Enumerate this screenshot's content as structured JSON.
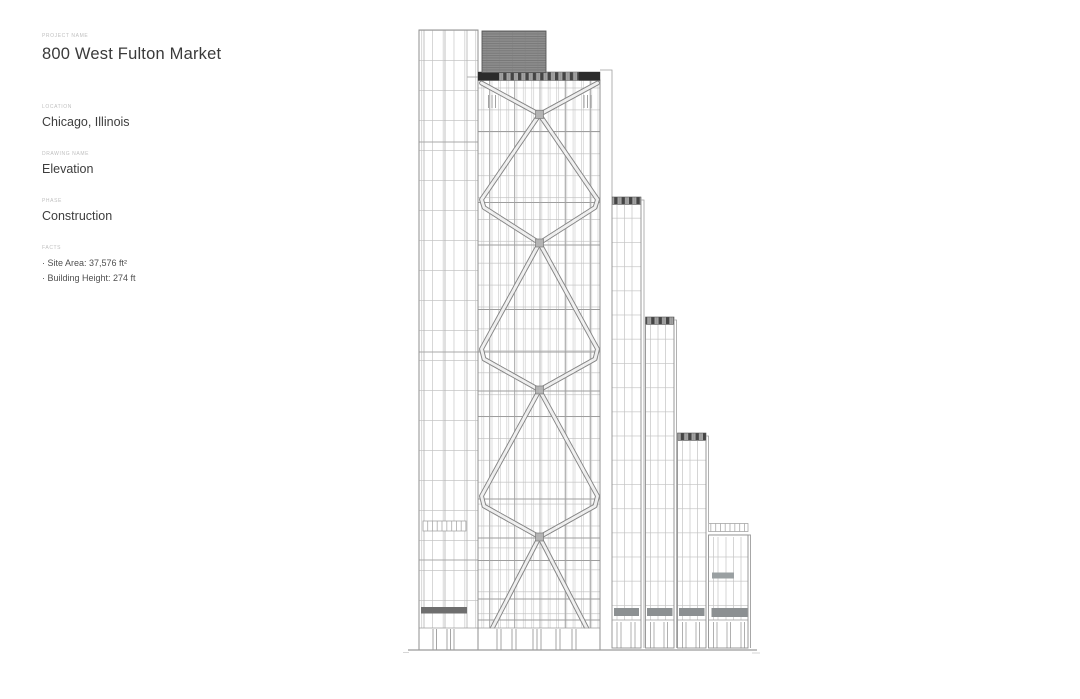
{
  "panel": {
    "fields": [
      {
        "label": "PROJECT NAME",
        "value": "800 West Fulton Market"
      },
      {
        "label": "LOCATION",
        "value": "Chicago, Illinois"
      },
      {
        "label": "DRAWING NAME",
        "value": "Elevation"
      },
      {
        "label": "PHASE",
        "value": "Construction"
      }
    ],
    "facts_label": "FACTS",
    "facts": [
      "· Site Area: 37,576 ft²",
      "· Building Height: 274 ft"
    ]
  },
  "drawing": {
    "title": "Building elevation line drawing",
    "building": "800 West Fulton Market tower with X-braced facade, rooftop mechanical penthouse and four stepped setback wings descending to the east",
    "colors": {
      "line_light": "#c6c6c6",
      "line_medium": "#8f8f8f",
      "penthouse_gray": "#8e8e8e",
      "parapet_dark": "#2c2c2c",
      "band_hatch_dark": "#454545",
      "band_hatch_gray": "#a3a3a3",
      "spandrel_gray": "#8c9092",
      "entry_band_gray": "#6e6e6e",
      "ground": "#9a9a9a",
      "text_dark": "#3d3d3d",
      "label_gray": "#bfbfbf"
    }
  }
}
